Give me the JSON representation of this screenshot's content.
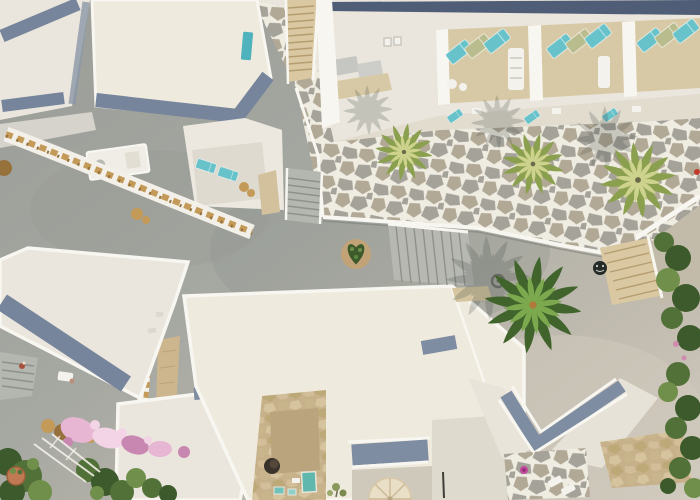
{
  "meta": {
    "domain": "natural-image",
    "description": "Top-down aerial drone photograph of a whitewashed Cycladic island hotel complex: flat white roofs edged with blue-grey parapet shadows, balconies with teal and olive sun loungers, a flagstone terrace with palm trees, a grey paved plaza with staircases, a heart-shaped shrub, bougainvillea in bloom and garden strips."
  },
  "palette": {
    "pavement": "#a6a8a2",
    "pavement_dark": "#90948e",
    "pavement_light": "#cfc9bb",
    "roof_white": "#eae6dd",
    "roof_white_warm": "#efeade",
    "parapet_white": "#f8f6f0",
    "white_detail": "#f4f2ec",
    "roof_shadow_band": "#76859b",
    "roof_shadow_band_light": "#7e8da2",
    "navy_roof": "#4f5d76",
    "flag_grout": "#efece2",
    "flag_stone": "#a5a29a",
    "flag_stone_warm": "#b2a896",
    "balcony_floor": "#d8c9a6",
    "terrace_floor": "#e2dccf",
    "lounger_teal": "#68c2ca",
    "lounger_olive": "#b9bc8d",
    "teal_hatch": "#4fb3bd",
    "stair_tan": "#d9c8a2",
    "stair_tread_tan": "#b59d72",
    "stair_grey": "#b4b6b0",
    "stair_tread": "#8f928c",
    "courtyard_tan": "#c7b18b",
    "courtyard_floor": "#baa47e",
    "courtyard_line": "#a8936e",
    "pool_teal": "#5fb7ad",
    "palm_yellow_light": "#cdd28d",
    "palm_yellow_dark": "#8ba04f",
    "palm_green_light": "#7ca94e",
    "palm_green_dark": "#41642c",
    "bush_green": "#527138",
    "bush_green_dark": "#3c5a2b",
    "bush_green_light": "#6f8f4a",
    "bougainvillea_pink": "#e7b6d3",
    "bougainvillea_pink_deep": "#c787b0",
    "bougainvillea_pink_light": "#f3d3e6",
    "garland_gold": "#c49a58",
    "garland_gold_dark": "#96713c",
    "terracotta": "#bf7a53",
    "shadow_tint": "#404a44",
    "pot_pink": "#c2499b",
    "pot_dark": "#3a332c",
    "umbrella_beige": "#e9dec6",
    "umbrella_line": "#cbb896",
    "ac_grey": "#c6c7c2",
    "manhole_dark": "#262b28",
    "red_flower": "#c0392b",
    "person_skin": "#a84f3c"
  },
  "scene": {
    "setting": "whitewashed resort complex seen straight from above",
    "buildings_with_blue_shadow_bands": 7,
    "palm_trees": 4,
    "palm_shadows": 4,
    "balcony_bays": 3,
    "loungers_per_bay": 3,
    "lounger_colors": [
      "teal",
      "olive",
      "teal"
    ],
    "small_teal_daybeds": 5,
    "staircases": 5,
    "flagstone_terrace": true,
    "stone_plaza": true,
    "heart_shaped_shrub": 1,
    "garland_decorated_walkways": 2,
    "bougainvillea_clusters": 1,
    "garden_strips": 2,
    "plunge_pools": 3,
    "beige_parasol": 1,
    "terracotta_pot": 1,
    "pink_flower_pot": 1,
    "manhole_covers": 2,
    "people_visible": 2
  }
}
